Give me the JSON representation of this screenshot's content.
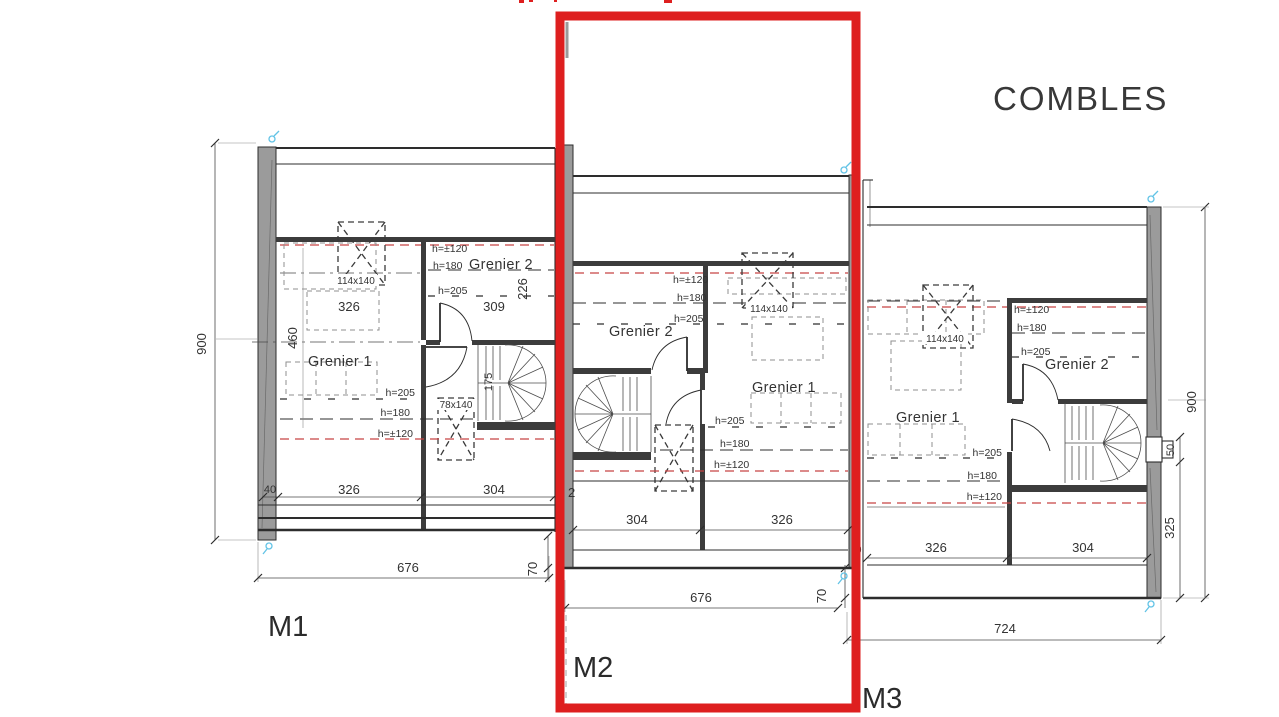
{
  "title": "COMBLES",
  "colors": {
    "highlight_red": "#de1f1f",
    "wall_gray": "#9b9b9b",
    "line_dark": "#2d2d2d",
    "marker_blue": "#62c3e6",
    "low_height_dash_red": "#c74343"
  },
  "units": {
    "m1": {
      "label": "M1",
      "room_grenier1": "Grenier 1",
      "room_grenier2": "Grenier 2",
      "dim_height": "900",
      "dim_depth": "460",
      "dim_226": "226",
      "dim_326_top": "326",
      "dim_309": "309",
      "skylight_main": "114x140",
      "skylight_stair": "78x140",
      "h120_upper": "h=±120",
      "h180_upper": "h=180",
      "h205_upper": "h=205",
      "h205_lower": "h=205",
      "h180_lower": "h=180",
      "h120_lower": "h=±120",
      "stair_width": "175",
      "dim_wall": "40",
      "dim_326_bottom": "326",
      "dim_304_bottom": "304",
      "dim_width": "676",
      "dim_offset": "70"
    },
    "m2": {
      "label": "M2",
      "room_grenier1": "Grenier 1",
      "room_grenier2": "Grenier 2",
      "h120_upper": "h=±120",
      "h180_upper": "h=180",
      "h205_upper": "h=205",
      "skylight_main": "114x140",
      "h205_lower": "h=205",
      "h180_lower": "h=180",
      "h120_lower": "h=±120",
      "dim_304_bottom": "304",
      "dim_326_bottom": "326",
      "dim_width": "676",
      "dim_offset": "70",
      "dim_partial": "2"
    },
    "m3": {
      "label": "M3",
      "room_grenier1": "Grenier 1",
      "room_grenier2": "Grenier 2",
      "h120_upper": "h=±120",
      "h180_upper": "h=180",
      "h205_upper": "h=205",
      "skylight_main": "114x140",
      "h205_lower": "h=205",
      "h180_lower": "h=180",
      "h120_lower": "h=±120",
      "dim_326_bottom": "326",
      "dim_304_bottom": "304",
      "dim_width": "724",
      "dim_height": "900",
      "dim_window": "50",
      "dim_325": "325",
      "dim_partial": "0"
    }
  }
}
